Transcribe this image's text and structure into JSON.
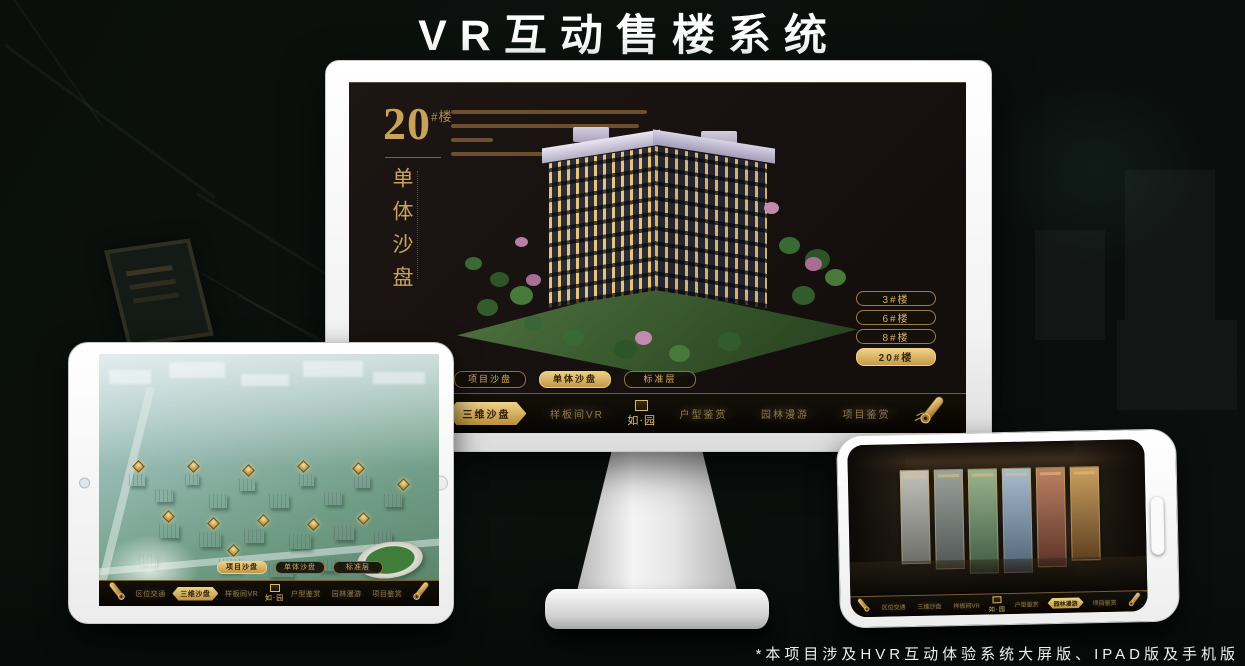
{
  "page": {
    "title": "VR互动售楼系统",
    "footnote": "*本项目涉及HVR互动体验系统大屏版、IPAD版及手机版"
  },
  "colors": {
    "gold": "#c9a25c",
    "gold_bright": "#ecd28a",
    "screen_bg": "#171110",
    "nav_bg": "#0b0704"
  },
  "icons": {
    "scroll_menu": "gold rolled scroll",
    "logo_seal": "square gold seal above logo text"
  },
  "monitor": {
    "headline": {
      "number": "20",
      "suffix": "#楼",
      "subtitle": "单体沙盘"
    },
    "floor_buttons": [
      "3#楼",
      "6#楼",
      "8#楼",
      "20#楼"
    ],
    "active_floor": "20#楼",
    "sub_tabs": [
      "项目沙盘",
      "单体沙盘",
      "标准层"
    ],
    "active_sub_tab": "单体沙盘",
    "nav": {
      "items": [
        "区位交通",
        "三维沙盘",
        "样板间VR",
        "户型鉴赏",
        "园林漫游",
        "项目鉴赏"
      ],
      "active": "三维沙盘",
      "logo": "如·园"
    }
  },
  "tablet": {
    "sub_tabs": [
      "项目沙盘",
      "单体沙盘",
      "标准层"
    ],
    "active_sub_tab": "项目沙盘",
    "nav": {
      "items": [
        "区位交通",
        "三维沙盘",
        "样板间VR",
        "户型鉴赏",
        "园林漫游",
        "项目鉴赏"
      ],
      "active": "三维沙盘",
      "logo": "如·园"
    }
  },
  "phone": {
    "nav": {
      "items": [
        "区位交通",
        "三维沙盘",
        "样板间VR",
        "户型鉴赏",
        "园林漫游",
        "项目鉴赏"
      ],
      "active": "园林漫游",
      "logo": "如·园"
    }
  }
}
